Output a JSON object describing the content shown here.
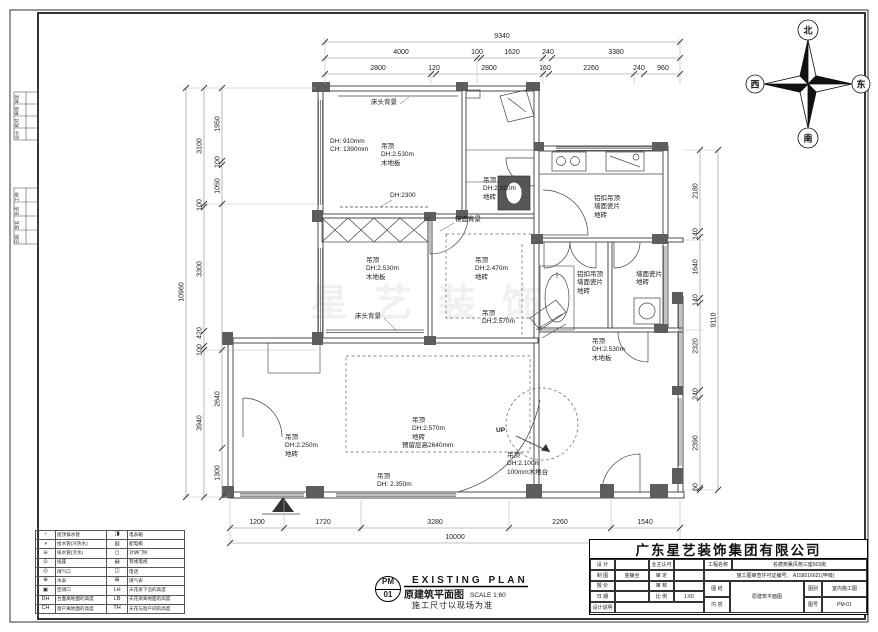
{
  "caption": {
    "code_top": "PM",
    "code_bottom": "01",
    "title_en": "EXISTING PLAN",
    "title_cn": "原建筑平面图",
    "scale": "SCALE 1:60",
    "note": "施工尺寸以现场为准"
  },
  "compass": {
    "n": "北",
    "s": "南",
    "e": "东",
    "w": "西"
  },
  "watermark": "星艺装饰",
  "margin": {
    "g1": [
      "审定",
      "审核",
      "校对",
      "设计"
    ],
    "g2": [
      "工种",
      "负责",
      "签名",
      "日期"
    ]
  },
  "dims": {
    "top": {
      "total": "9340",
      "row2": [
        "4000",
        "100",
        "1620",
        "240",
        "3380"
      ],
      "row3": [
        "2800",
        "120",
        "2800",
        "160",
        "2260",
        "240",
        "960"
      ]
    },
    "left": {
      "total": "10960",
      "outer": [
        "3100",
        "100",
        "3300",
        "420",
        "100",
        "3940"
      ],
      "inner": [
        "1950",
        "100",
        "1050",
        "2640",
        "1300"
      ]
    },
    "right": {
      "total": "9110",
      "segs": [
        "2180",
        "140",
        "1640",
        "140",
        "2320",
        "240",
        "2390",
        "60"
      ]
    },
    "bottom": {
      "total": "10000",
      "segs": [
        "1200",
        "1720",
        "3280",
        "2260",
        "1540"
      ]
    }
  },
  "plan": {
    "bed1_headboard": "床头背景",
    "bed1_window": "DH: 910mm\nCH: 1390mm",
    "bed1_ceiling": "吊顶\nDH:2.530m\n木地板",
    "bed1_dh2300": "DH:2300",
    "hall_top_ceiling": "吊顶\nDH:2.320m\n地砖",
    "mirror_bg": "镜面背景",
    "kitchen_finish": "铝扣吊顶\n墙面瓷片\n地砖",
    "bed2_ceiling": "吊顶\nDH:2.530m\n木地板",
    "dining_ceiling": "吊顶\nDH:2.470m\n地砖",
    "bath2_finish": "铝扣吊顶\n墙面瓷片\n地砖",
    "utility_finish": "墙面瓷片\n地砖",
    "bed2_headboard": "床头背景",
    "hall_ceiling": "吊顶\nDH:2.570m",
    "bed3_ceiling": "吊顶\nDH:2.530m\n木地板",
    "living_ceiling": "吊顶\nDH:2.570m\n地砖",
    "living_beam": "预留层高2640mm",
    "up_label": "UP",
    "stair_platform": "吊顶\nDH:2.100m\n100mm木地台",
    "entry_ceiling": "吊顶\nDH:2.250m\n地砖",
    "porch_ceiling": "吊顶\nDH: 2.350m"
  },
  "legend": {
    "rows": [
      {
        "s1": "○",
        "l1": "屋顶排水管",
        "s2": "◨",
        "l2": "电表箱"
      },
      {
        "s1": "◑",
        "l1": "给水管(冷热水)",
        "s2": "▥",
        "l2": "配电箱"
      },
      {
        "s1": "⊖",
        "l1": "排水管(污水)",
        "s2": "◻",
        "l2": "对讲门铃"
      },
      {
        "s1": "⊙",
        "l1": "插座",
        "s2": "▤",
        "l2": "有线电视"
      },
      {
        "s1": "◎",
        "l1": "煤气口",
        "s2": "◫",
        "l2": "电话"
      },
      {
        "s1": "⊕",
        "l1": "水表",
        "s2": "⊞",
        "l2": "煤气表"
      },
      {
        "s1": "▣",
        "l1": "空调口",
        "s2": "LH",
        "l2": "天花梁下沿的高度"
      },
      {
        "s1": "DH",
        "l1": "台面离地面的高度",
        "s2": "LB",
        "l2": "天花梁离地面的高度"
      },
      {
        "s1": "CH",
        "l1": "窗户离地面的高度",
        "s2": "TH",
        "l2": "天花与窗户间的高度"
      }
    ]
  },
  "titleblock": {
    "company": "广东星艺装饰集团有限公司",
    "design_label": "设 计",
    "design_value": "",
    "draft_label": "制 图",
    "draft_value": "金静全",
    "quote_label": "报 价",
    "quote_value": "",
    "date_label": "日 期",
    "date_value": "",
    "note_label": "设计说明",
    "owner_label": "业主认可",
    "owner_value": "",
    "approve_label": "审 定",
    "approve_value": "",
    "check_label": "审 核",
    "check_value": "",
    "scale_label": "比 例",
    "scale_value": "1:60",
    "project_label": "工程名称",
    "project_value": "名德苑薰风苑三座503房",
    "permit": "施工图审查许可证编号： A158016621(甲级)",
    "sheet_label": "图 纸",
    "content_label": "内 容",
    "sheet_value": "原建筑平面图",
    "type_label": "图别",
    "type_value": "室内施工图",
    "no_label": "图号",
    "no_value": "PM-01"
  }
}
